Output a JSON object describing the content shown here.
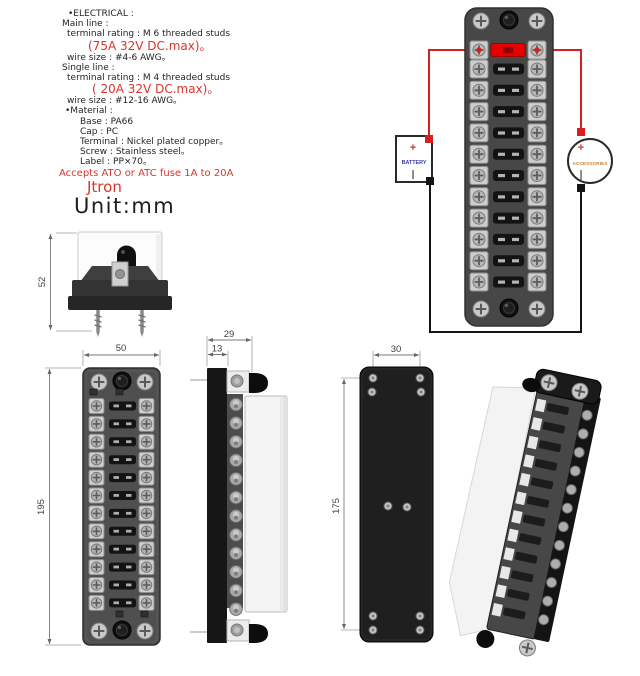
{
  "specs": {
    "lines": [
      {
        "text": "•ELECTRICAL :",
        "color": "dark",
        "size": 9,
        "indent": 10,
        "lh": 10.2
      },
      {
        "text": "Main line :",
        "color": "dark",
        "size": 9,
        "indent": 4,
        "lh": 10.2
      },
      {
        "text": "terminal rating : M 6 threaded studs",
        "color": "dark",
        "size": 9,
        "indent": 9,
        "lh": 10.2
      },
      {
        "text": "(75A 32V DC.max)。",
        "color": "red",
        "size": 12,
        "indent": 30,
        "lh": 13
      },
      {
        "text": "wire size : #4-6 AWG。",
        "color": "dark",
        "size": 9,
        "indent": 9,
        "lh": 10.2
      },
      {
        "text": "Single line :",
        "color": "dark",
        "size": 9,
        "indent": 4,
        "lh": 10.2
      },
      {
        "text": "terminal rating : M 4 threaded studs",
        "color": "dark",
        "size": 9,
        "indent": 9,
        "lh": 10.2
      },
      {
        "text": "( 20A 32V DC.max)。",
        "color": "red",
        "size": 12,
        "indent": 34,
        "lh": 13
      },
      {
        "text": "wire size : #12-16 AWG。",
        "color": "dark",
        "size": 9,
        "indent": 9,
        "lh": 10.2
      },
      {
        "text": "•Material :",
        "color": "dark",
        "size": 9,
        "indent": 7,
        "lh": 10.2
      },
      {
        "text": "Base : PA66",
        "color": "dark",
        "size": 9,
        "indent": 22,
        "lh": 10.2
      },
      {
        "text": "Cap : PC",
        "color": "dark",
        "size": 9,
        "indent": 22,
        "lh": 10.2
      },
      {
        "text": "Terminal : Nickel plated copper。",
        "color": "dark",
        "size": 9,
        "indent": 22,
        "lh": 10.2
      },
      {
        "text": "Screw : Stainless steel。",
        "color": "dark",
        "size": 9,
        "indent": 22,
        "lh": 10.2
      },
      {
        "text": "Label : PP×70。",
        "color": "dark",
        "size": 9,
        "indent": 22,
        "lh": 10.2
      },
      {
        "text": "Accepts ATO or ATC fuse 1A to 20A",
        "color": "red",
        "size": 10,
        "indent": 1,
        "lh": 11
      },
      {
        "text": "Jtron",
        "color": "red",
        "size": 15,
        "indent": 29,
        "lh": 17
      }
    ]
  },
  "unit_label": "Unit:mm",
  "wiring": {
    "battery_label": "BATTERY",
    "accessories_label": "ACCESSORIES",
    "plus": "+"
  },
  "dims": {
    "side_height": "52",
    "front_width": "50",
    "front_height": "195",
    "depth_total": "29",
    "depth_base": "13",
    "hole_pitch_x": "30",
    "hole_pitch_y": "175"
  },
  "product": {
    "fuse_positions": 12
  },
  "colors": {
    "dark": "#242424",
    "red": "#d8352a",
    "wire_red": "#d42020",
    "wire_black": "#141414",
    "battery_blue": "#3c3cae",
    "accessories_orange": "#c8863c",
    "fuse_red": "#e80000"
  }
}
